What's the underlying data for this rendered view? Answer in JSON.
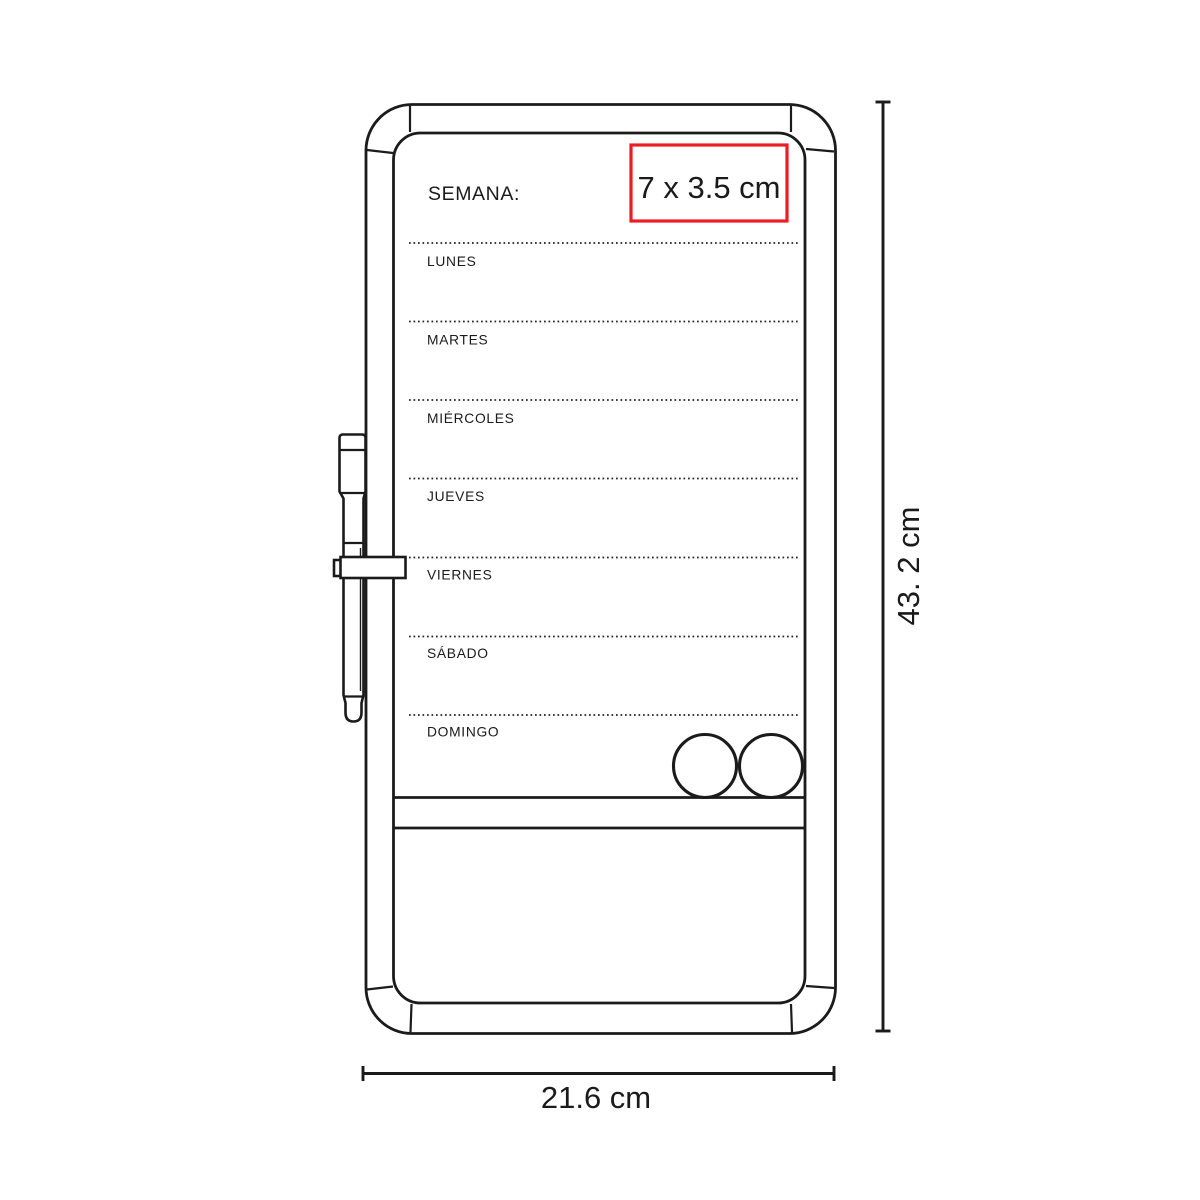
{
  "diagram": {
    "board": {
      "header_label": "SEMANA:",
      "days": [
        "LUNES",
        "MARTES",
        "MIÉRCOLES",
        "JUEVES",
        "VIERNES",
        "SÁBADO",
        "DOMINGO"
      ]
    },
    "print_area": {
      "label": "7 x 3.5 cm",
      "border_color": "#EC1C24"
    },
    "dimensions": {
      "height_label": "43. 2 cm",
      "width_label": "21.6 cm"
    },
    "colors": {
      "line": "#1B1B1B",
      "text": "#1A1A1A",
      "background": "#FFFFFF",
      "accent_red": "#EC1C24"
    }
  }
}
